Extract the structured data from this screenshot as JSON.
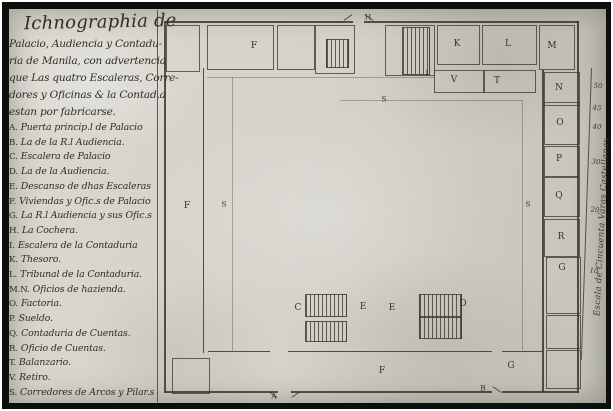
{
  "title": {
    "heading": "Ichnographia de",
    "lines": [
      "Palacio, Audiencia y Contadu-",
      "ria de Manila, con advertencia",
      "que Las quatro Escaleras, Corre-",
      "dores y Oficinas & la Contad.a",
      "estan por fabricarse."
    ]
  },
  "legend": {
    "items": [
      {
        "key": "A.",
        "text": "Puerta princip.l de Palacio"
      },
      {
        "key": "B.",
        "text": "La de la R.l Audiencia."
      },
      {
        "key": "C.",
        "text": "Escalera de Palacio"
      },
      {
        "key": "D.",
        "text": "La de la Audiencia."
      },
      {
        "key": "E.",
        "text": "Descanso de dhas Escaleras"
      },
      {
        "key": "F.",
        "text": "Viviendas y Ofic.s de Palacio"
      },
      {
        "key": "G.",
        "text": "La R.l Audiencia y sus Ofic.s"
      },
      {
        "key": "H.",
        "text": "La Cochera."
      },
      {
        "key": "I.",
        "text": "Escalera de la Contaduria"
      },
      {
        "key": "K.",
        "text": "Thesoro."
      },
      {
        "key": "L.",
        "text": "Tribunal de la Contaduria."
      },
      {
        "key": "M.N.",
        "text": "Oficios de hazienda."
      },
      {
        "key": "O.",
        "text": "Factoria."
      },
      {
        "key": "P.",
        "text": "Sueldo."
      },
      {
        "key": "Q.",
        "text": "Contaduria de Cuentas."
      },
      {
        "key": "R.",
        "text": "Oficio de Cuentas."
      },
      {
        "key": "T.",
        "text": "Balanzario."
      },
      {
        "key": "V.",
        "text": "Retiro."
      },
      {
        "key": "S.",
        "text": "Corredores de Arcos y Pilar.s"
      }
    ]
  },
  "plan": {
    "labels": [
      {
        "t": "H"
      },
      {
        "t": "F"
      },
      {
        "t": "I"
      },
      {
        "t": "K"
      },
      {
        "t": "L"
      },
      {
        "t": "M"
      },
      {
        "t": "V"
      },
      {
        "t": "T"
      },
      {
        "t": "N"
      },
      {
        "t": "O"
      },
      {
        "t": "P"
      },
      {
        "t": "Q"
      },
      {
        "t": "R"
      },
      {
        "t": "G"
      },
      {
        "t": "S"
      },
      {
        "t": "S"
      },
      {
        "t": "S"
      },
      {
        "t": "F"
      },
      {
        "t": "C"
      },
      {
        "t": "E"
      },
      {
        "t": "E"
      },
      {
        "t": "D"
      },
      {
        "t": "G"
      },
      {
        "t": "B"
      },
      {
        "t": "F"
      },
      {
        "t": "A"
      }
    ],
    "scale": {
      "text": "Escala de Cincuenta Varas Castellanas",
      "ticks": [
        "50",
        "45",
        "40",
        "30",
        "20",
        "10"
      ]
    }
  },
  "colors": {
    "paper": "#d3d1c9",
    "ink": "#35332b",
    "frame": "#0e0e0c"
  }
}
